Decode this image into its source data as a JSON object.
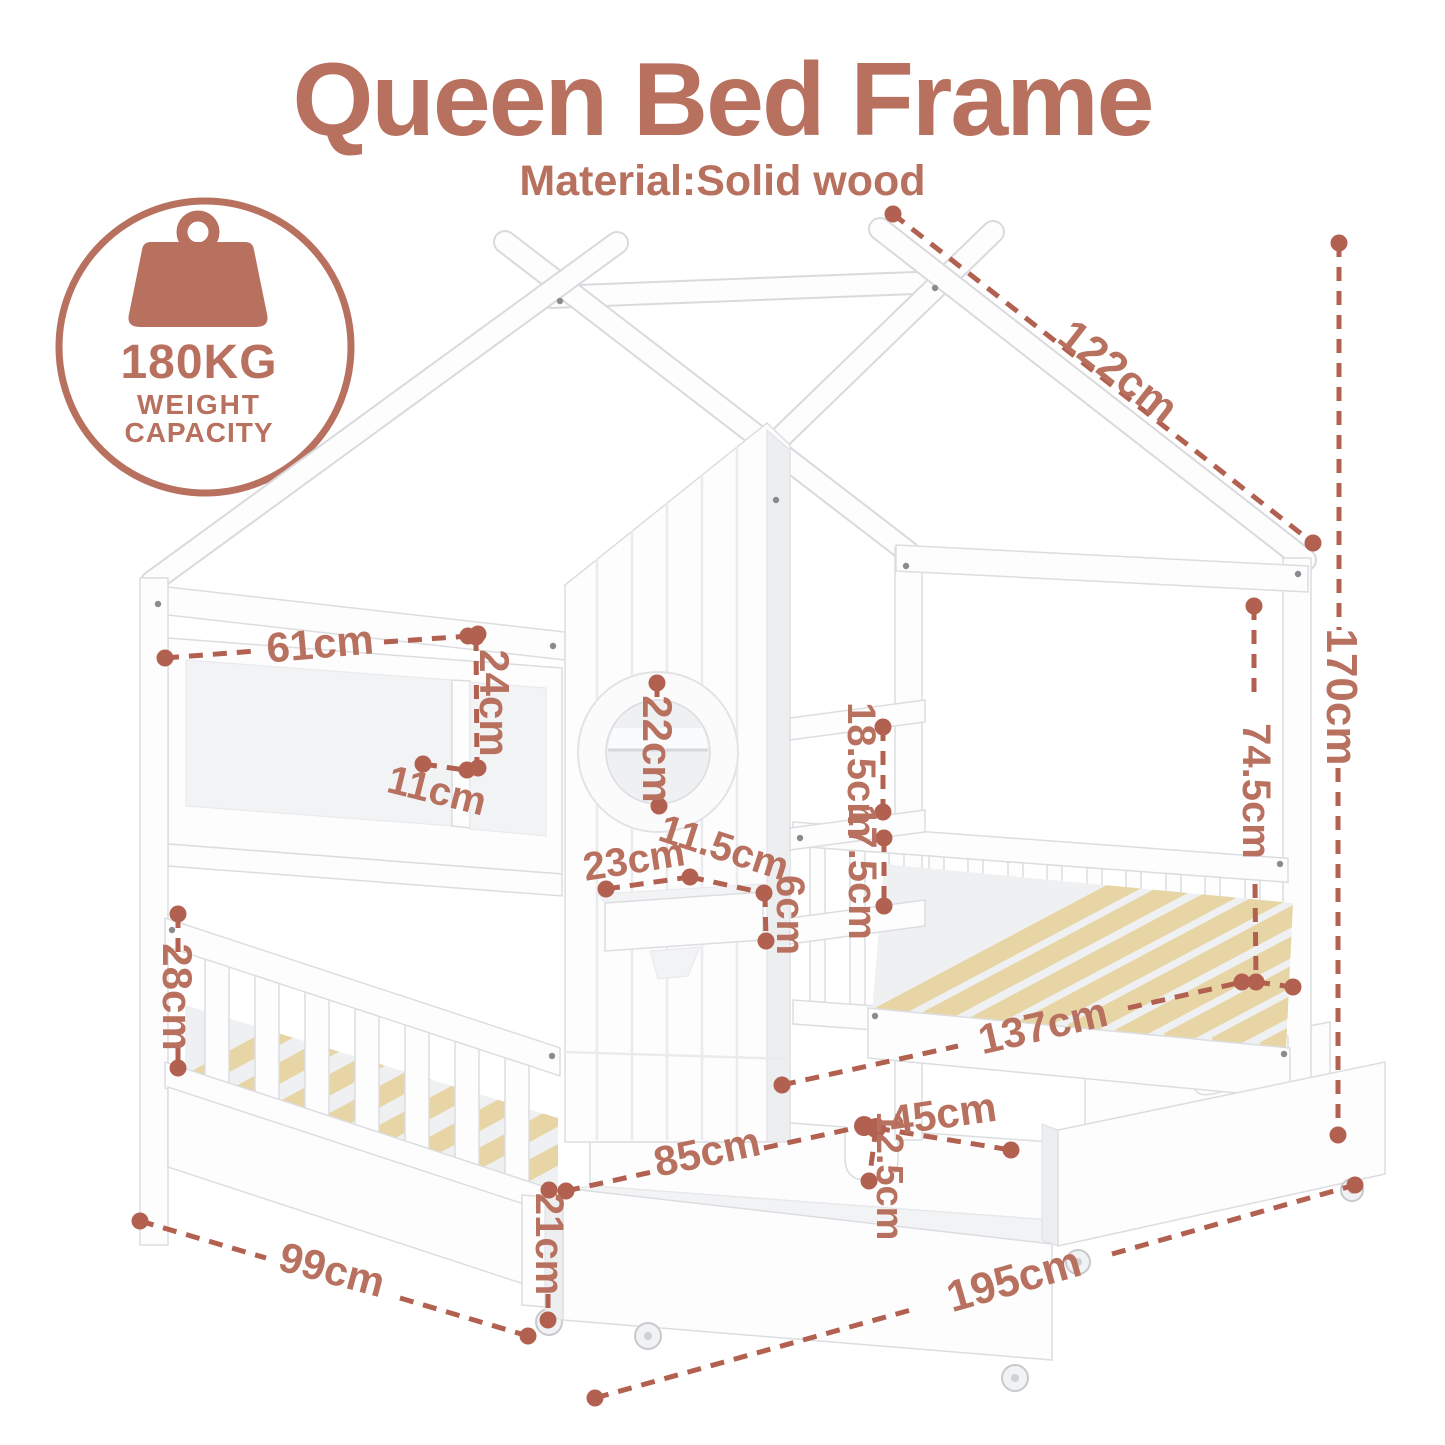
{
  "header": {
    "title": "Queen Bed Frame",
    "subtitle": "Material:Solid wood"
  },
  "badge": {
    "weight_icon_label": "KG",
    "capacity": "180KG",
    "capacity_caption_line1": "WEIGHT",
    "capacity_caption_line2": "CAPACITY"
  },
  "dimensions": {
    "roof_beam_length": "122cm",
    "overall_height": "170cm",
    "canopy_post_height": "74.5cm",
    "headboard_shelf_width": "61cm",
    "headboard_shelf_height": "24cm",
    "headboard_shelf_depth": "11cm",
    "window_diameter": "22cm",
    "bookshelf_gap_upper": "18.5cm",
    "bookshelf_gap_lower": "17.5cm",
    "wall_shelf_width": "23cm",
    "wall_shelf_depth": "11.5cm",
    "wall_shelf_height": "6cm",
    "guard_rail_height": "28cm",
    "bed_inner_length": "137cm",
    "drawer_depth": "45cm",
    "drawer_length": "85cm",
    "drawer_handle_notch": "12.5cm",
    "drawer_height": "21cm",
    "frame_width": "99cm",
    "frame_length": "195cm"
  },
  "colors": {
    "accent_text": "#b8705f",
    "accent_line": "#b2604f",
    "wood_slat": "#e8d5a6"
  }
}
